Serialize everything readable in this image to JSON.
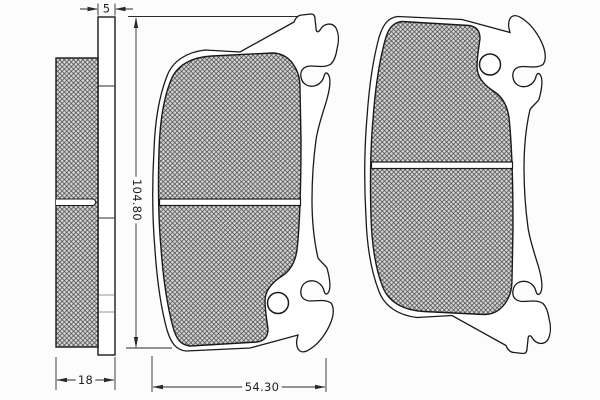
{
  "drawing": {
    "kind": "brake-pad-set-technical-drawing",
    "dimensions": {
      "plate_thickness": "5",
      "pad_thickness": "18",
      "pad_height": "104.80",
      "pad_width": "54.30"
    },
    "colors": {
      "outline": "#1a1a1a",
      "dimension": "#2a2a2a",
      "hatch_background": "#d6d6d6",
      "hatch_line": "#404040",
      "hidden_line": "#8a8a8a",
      "canvas": "#fcfcfc"
    }
  }
}
